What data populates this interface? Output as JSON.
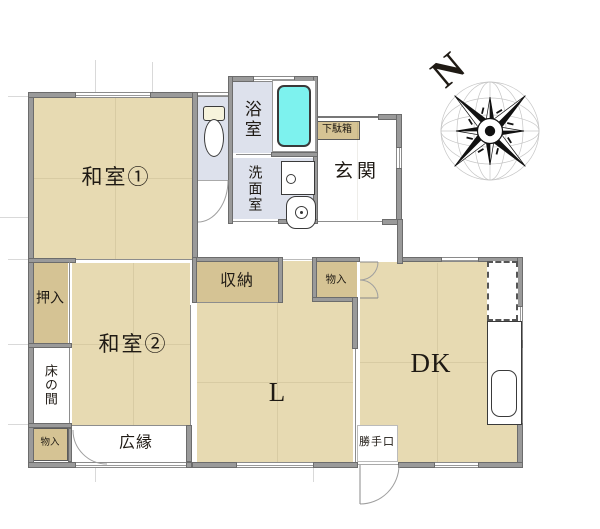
{
  "plan_title": "Japanese house floor plan",
  "colors": {
    "room_fill": "#e7dab2",
    "closet_fill": "#d5c394",
    "wet_area_fill": "#dde1ec",
    "bathtub_fill": "#7df2ee",
    "wall": "#9a9a9a"
  },
  "rooms": {
    "washitsu1": "和室①",
    "washitsu2": "和室②",
    "living": "L",
    "dining_kitchen": "DK",
    "genkan": "玄関",
    "bathroom": "浴室",
    "washroom": "洗面室",
    "storage_shuno": "収納",
    "closet_oshiire": "押入",
    "tokonoma": "床の間",
    "storage_left": "物入",
    "storage_center": "物入",
    "veranda_hiroen": "広縁",
    "back_door": "勝手口",
    "shoe_cabinet": "下駄箱"
  },
  "compass": {
    "north": "N"
  },
  "fixtures": [
    "toilet",
    "bathtub",
    "washbasin",
    "washing-machine",
    "kitchen-counter",
    "kitchen-sink",
    "refrigerator-space"
  ]
}
